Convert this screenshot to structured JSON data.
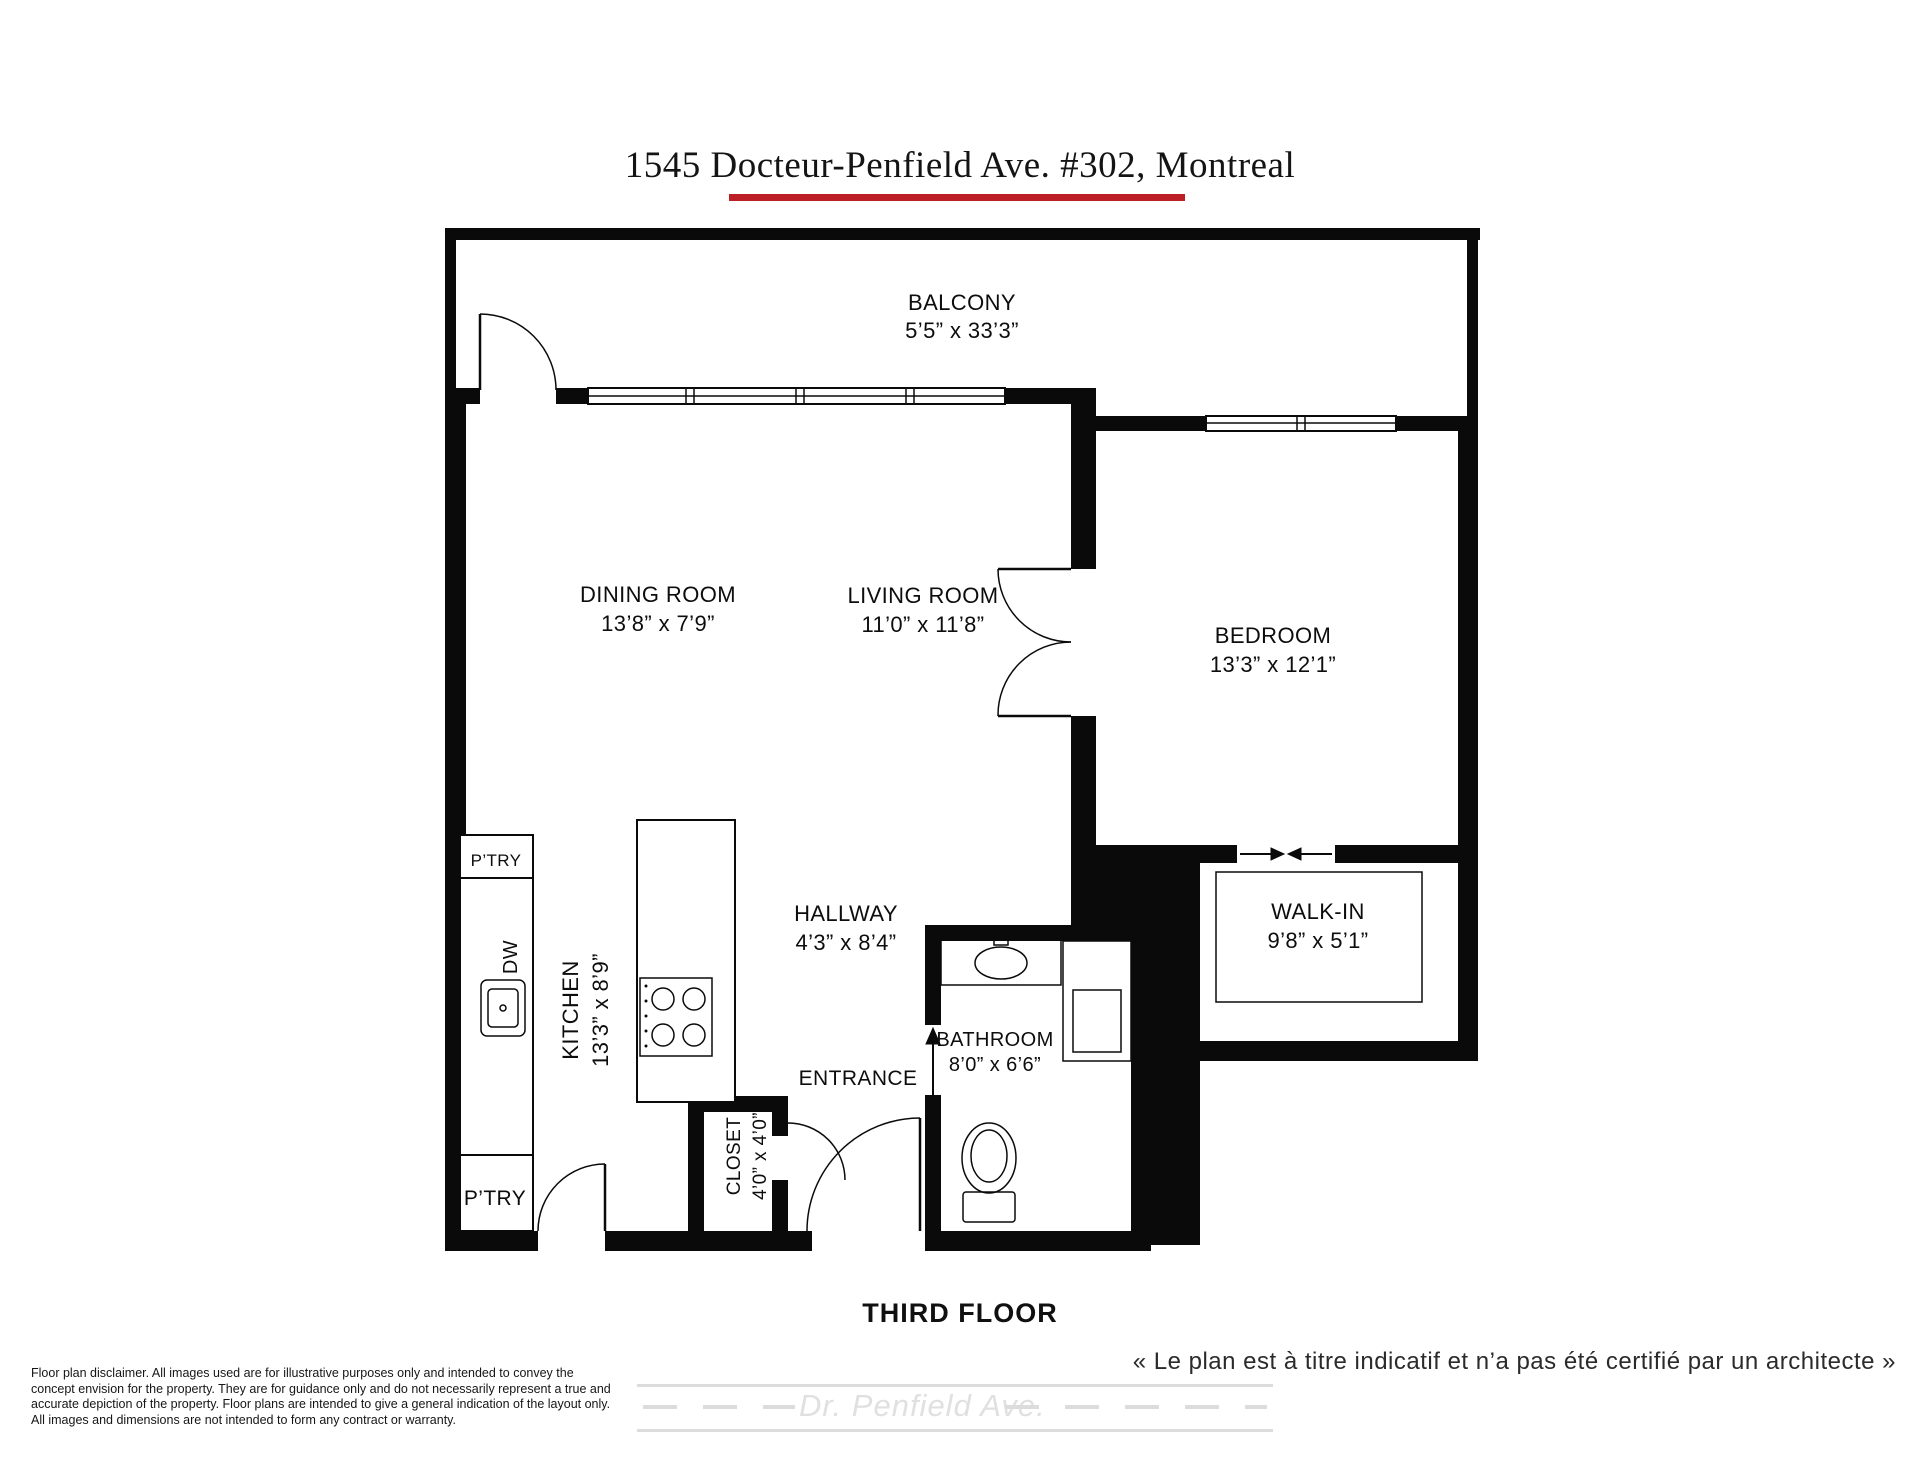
{
  "header": {
    "title": "1545 Docteur-Penfield Ave. #302, Montreal"
  },
  "rooms": {
    "balcony": {
      "name": "BALCONY",
      "dims": "5’5” x 33’3”"
    },
    "dining": {
      "name": "DINING ROOM",
      "dims": "13’8” x 7’9”"
    },
    "living": {
      "name": "LIVING ROOM",
      "dims": "11’0” x 11’8”"
    },
    "bedroom": {
      "name": "BEDROOM",
      "dims": "13’3” x 12’1”"
    },
    "walkin": {
      "name": "WALK-IN",
      "dims": "9’8” x 5’1”"
    },
    "hallway": {
      "name": "HALLWAY",
      "dims": "4’3” x 8’4”"
    },
    "bathroom": {
      "name": "BATHROOM",
      "dims": "8’0” x 6’6”"
    },
    "kitchen": {
      "name": "KITCHEN",
      "dims": "13’3” x 8’9”"
    },
    "closet": {
      "name": "CLOSET",
      "dims": "4’0” x 4’0”"
    },
    "entrance": {
      "name": "ENTRANCE"
    },
    "pantry_top": {
      "name": "P’TRY"
    },
    "pantry_bottom": {
      "name": "P’TRY"
    },
    "dishwasher": {
      "name": "DW"
    }
  },
  "floor": {
    "label": "THIRD FLOOR"
  },
  "footer": {
    "disclaimer_lines": [
      "Floor plan disclaimer. All images used are for illustrative purposes only and intended to convey the",
      "concept envision for the property. They are for guidance only and do not necessarily represent a true and",
      "accurate depiction of the property. Floor plans are intended to give a general indication of the layout only.",
      "All images and dimensions are not intended to form any contract or warranty."
    ],
    "french_note": "« Le plan est à titre indicatif et n’a pas été certifié par un architecte »",
    "street_name": "Dr. Penfield Ave."
  },
  "colors": {
    "walls": "#0a0a0a",
    "accent_underline": "#bc2026",
    "road_gray": "#dcdcdc"
  }
}
